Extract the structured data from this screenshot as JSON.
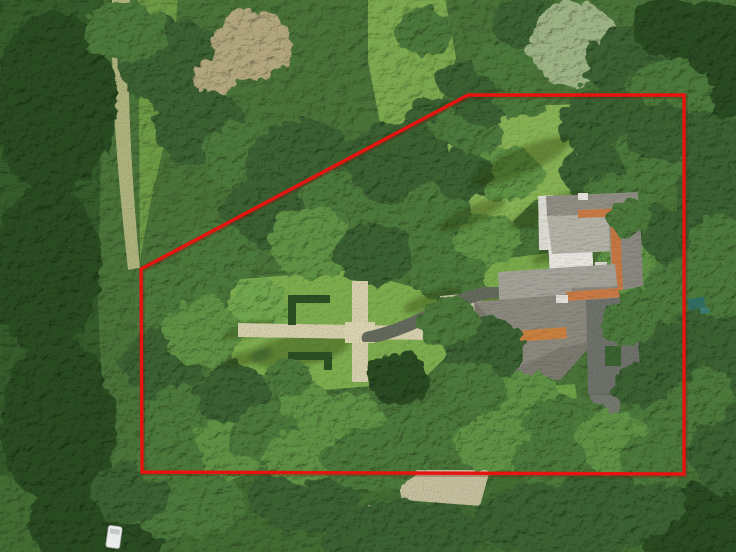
{
  "annotation": {
    "type": "property-boundary-outline",
    "color": "#e5140e",
    "shadow_color": "#7a0a06",
    "stroke_width": 3.4,
    "points": "468,95 684,95 684,474 142,472 141,269"
  },
  "scene": {
    "kind": "aerial-drone-photograph",
    "subject": "wooded estate with thatched-roof villa, formal garden and outlined parcel",
    "features": [
      "dense-forest",
      "north-lawn",
      "formal-garden-gravel-cross",
      "boxwood-hedges",
      "estate-house",
      "white-terrace-court",
      "asphalt-driveway",
      "forest-trail",
      "white-van",
      "teal-shed"
    ]
  },
  "palette": {
    "forest_base": "#4a7338",
    "canopy_tones": [
      "#2a4c24",
      "#3a6030",
      "#4c783a",
      "#5e9144",
      "#70a54d",
      "#84b45b",
      "#9cb284",
      "#b1a67d"
    ],
    "shadow": "#17300f",
    "lawn": "#79a84b",
    "lawn_bright": "#86b053",
    "gravel": "#d7d0ae",
    "trail": "#aeb37e",
    "dark_path": "#646a5c",
    "terrace_white": "#e6e5df",
    "courtyard": "#a3a198",
    "roof_light": "#b3b1a6",
    "roof_mid": "#989689",
    "roof_dark": "#8b897e",
    "ridge_orange": "#c97a45",
    "driveway": "#6e726b",
    "hedge": "#2c5023",
    "van_white": "#e9edec",
    "shed_teal": "#2f6b63"
  },
  "trees_under": [
    [
      50,
      100,
      62,
      92,
      0
    ],
    [
      42,
      265,
      55,
      82,
      0
    ],
    [
      55,
      420,
      58,
      85,
      0
    ],
    [
      95,
      522,
      72,
      42,
      0
    ],
    [
      170,
      62,
      55,
      46,
      1
    ],
    [
      122,
      28,
      42,
      30,
      2
    ],
    [
      195,
      122,
      46,
      40,
      1
    ],
    [
      242,
      152,
      40,
      34,
      2
    ],
    [
      710,
      58,
      50,
      62,
      0
    ],
    [
      716,
      202,
      42,
      72,
      1
    ],
    [
      712,
      352,
      40,
      72,
      1
    ],
    [
      692,
      522,
      62,
      42,
      0
    ],
    [
      420,
      28,
      30,
      24,
      2
    ],
    [
      458,
      76,
      26,
      20,
      1
    ],
    [
      500,
      55,
      30,
      25,
      2
    ],
    [
      525,
      18,
      35,
      28,
      1
    ],
    [
      570,
      40,
      45,
      42,
      6
    ],
    [
      625,
      60,
      42,
      36,
      1
    ],
    [
      663,
      22,
      36,
      30,
      0
    ],
    [
      665,
      95,
      45,
      40,
      2
    ],
    [
      700,
      142,
      40,
      36,
      1
    ],
    [
      715,
      262,
      36,
      52,
      2
    ],
    [
      722,
      442,
      40,
      48,
      1
    ],
    [
      700,
      392,
      30,
      30,
      2
    ],
    [
      180,
      500,
      60,
      36,
      2
    ],
    [
      300,
      496,
      56,
      32,
      1
    ],
    [
      125,
      488,
      40,
      30,
      1
    ],
    [
      400,
      532,
      80,
      36,
      1
    ],
    [
      560,
      516,
      90,
      40,
      1
    ],
    [
      620,
      500,
      60,
      36,
      1
    ],
    [
      248,
      42,
      40,
      34,
      7
    ],
    [
      210,
      72,
      22,
      18,
      7
    ],
    [
      300,
      165,
      60,
      48,
      1
    ],
    [
      345,
      205,
      48,
      40,
      2
    ],
    [
      395,
      160,
      52,
      42,
      1
    ],
    [
      430,
      215,
      40,
      34,
      2
    ],
    [
      260,
      210,
      42,
      36,
      1
    ],
    [
      215,
      252,
      40,
      32,
      2
    ],
    [
      310,
      240,
      45,
      36,
      3
    ],
    [
      370,
      250,
      40,
      32,
      1
    ],
    [
      432,
      120,
      34,
      27,
      1
    ],
    [
      470,
      130,
      30,
      24,
      2
    ],
    [
      455,
      120,
      26,
      22,
      2
    ],
    [
      500,
      170,
      40,
      26,
      3
    ],
    [
      175,
      300,
      45,
      40,
      2
    ],
    [
      160,
      360,
      40,
      38,
      1
    ],
    [
      200,
      330,
      38,
      34,
      3
    ],
    [
      185,
      420,
      48,
      40,
      2
    ],
    [
      230,
      390,
      36,
      32,
      1
    ],
    [
      225,
      446,
      40,
      30,
      3
    ],
    [
      165,
      456,
      35,
      25,
      2
    ],
    [
      265,
      430,
      38,
      30,
      2
    ],
    [
      300,
      452,
      40,
      28,
      3
    ],
    [
      255,
      300,
      30,
      26,
      4
    ],
    [
      480,
      100,
      30,
      22,
      1
    ],
    [
      520,
      95,
      28,
      20,
      2
    ],
    [
      600,
      120,
      45,
      36,
      1
    ],
    [
      640,
      160,
      40,
      34,
      2
    ],
    [
      590,
      170,
      35,
      28,
      1
    ],
    [
      460,
      172,
      28,
      24,
      1
    ],
    [
      615,
      200,
      38,
      30,
      2
    ],
    [
      650,
      232,
      36,
      30,
      1
    ],
    [
      648,
      292,
      38,
      32,
      2
    ],
    [
      656,
      352,
      40,
      34,
      1
    ],
    [
      650,
      420,
      42,
      34,
      2
    ],
    [
      620,
      262,
      30,
      26,
      3
    ],
    [
      660,
      130,
      35,
      30,
      1
    ],
    [
      445,
      265,
      40,
      32,
      2
    ],
    [
      485,
      235,
      32,
      26,
      3
    ]
  ],
  "trees_over": [
    [
      480,
      345,
      40,
      34,
      1
    ],
    [
      445,
      318,
      30,
      24,
      2
    ],
    [
      520,
      400,
      42,
      32,
      3
    ],
    [
      565,
      425,
      45,
      34,
      2
    ],
    [
      610,
      440,
      40,
      32,
      3
    ],
    [
      650,
      456,
      35,
      26,
      2
    ],
    [
      395,
      374,
      32,
      26,
      0
    ],
    [
      340,
      420,
      45,
      30,
      3
    ],
    [
      420,
      432,
      45,
      32,
      2
    ],
    [
      490,
      440,
      40,
      28,
      3
    ],
    [
      545,
      456,
      38,
      26,
      2
    ],
    [
      470,
      385,
      34,
      26,
      2
    ],
    [
      625,
      320,
      28,
      22,
      2
    ],
    [
      636,
      382,
      28,
      22,
      1
    ],
    [
      370,
      456,
      50,
      30,
      2
    ],
    [
      300,
      395,
      26,
      20,
      3
    ],
    [
      282,
      372,
      24,
      18,
      2
    ],
    [
      625,
      215,
      22,
      18,
      2
    ]
  ],
  "shadows": [
    [
      520,
      162,
      55,
      13,
      -24
    ],
    [
      548,
      210,
      42,
      10,
      -24
    ],
    [
      472,
      215,
      36,
      9,
      -24
    ],
    [
      512,
      300,
      42,
      11,
      -20
    ],
    [
      432,
      300,
      30,
      8,
      -20
    ],
    [
      560,
      250,
      30,
      8,
      -24
    ],
    [
      248,
      330,
      26,
      7,
      -15
    ],
    [
      248,
      358,
      26,
      7,
      -15
    ],
    [
      300,
      350,
      50,
      16,
      -10
    ]
  ]
}
